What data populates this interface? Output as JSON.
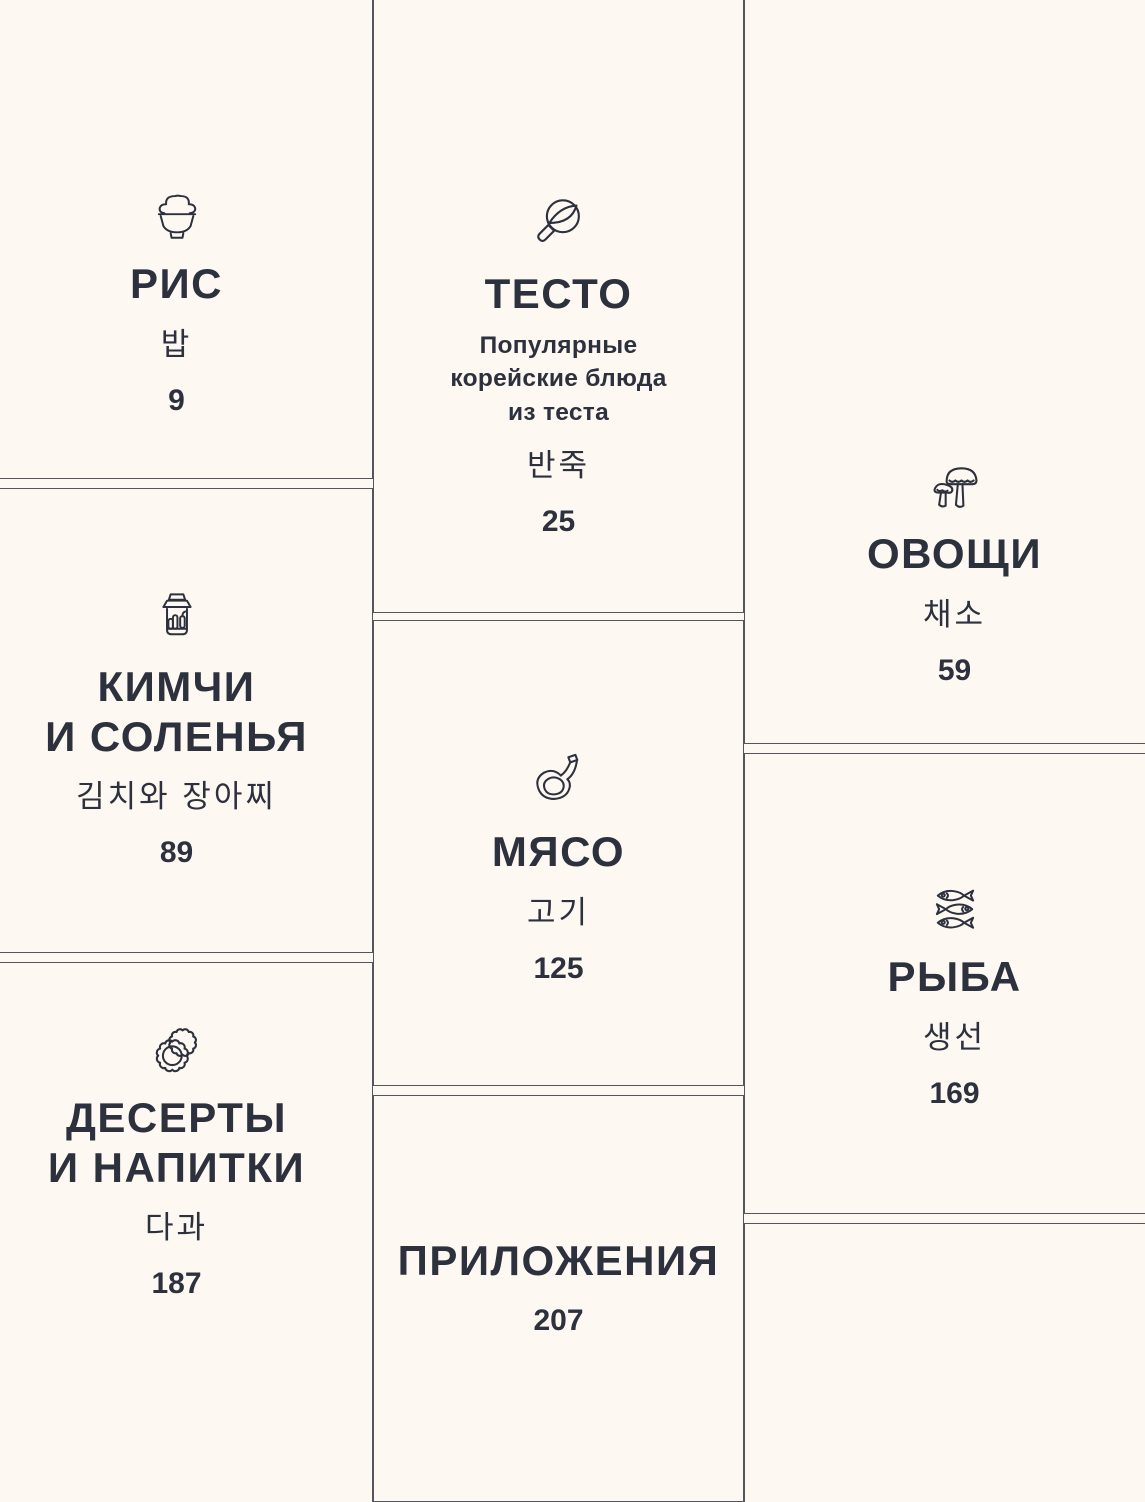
{
  "theme": {
    "background": "#fdf8f2",
    "text_color": "#2d313d",
    "border_color": "#55565c"
  },
  "cards": {
    "rice": {
      "title": "РИС",
      "korean": "밥",
      "page": "9",
      "icon": "rice-bowl-icon"
    },
    "dough": {
      "title": "ТЕСТО",
      "subtitle": "Популярные\nкорейские блюда\nиз теста",
      "korean": "반죽",
      "page": "25",
      "icon": "frying-pan-icon"
    },
    "vegetables": {
      "title": "ОВОЩИ",
      "korean": "채소",
      "page": "59",
      "icon": "mushrooms-icon"
    },
    "kimchi": {
      "title": "КИМЧИ\nИ СОЛЕНЬЯ",
      "korean": "김치와 장아찌",
      "page": "89",
      "icon": "pickle-jar-icon"
    },
    "meat": {
      "title": "МЯСО",
      "korean": "고기",
      "page": "125",
      "icon": "meat-bone-icon"
    },
    "fish": {
      "title": "РЫБА",
      "korean": "생선",
      "page": "169",
      "icon": "fish-icon"
    },
    "desserts": {
      "title": "ДЕСЕРТЫ\nИ НАПИТКИ",
      "korean": "다과",
      "page": "187",
      "icon": "plates-icon"
    },
    "appendix": {
      "title": "ПРИЛОЖЕНИЯ",
      "page": "207"
    }
  }
}
